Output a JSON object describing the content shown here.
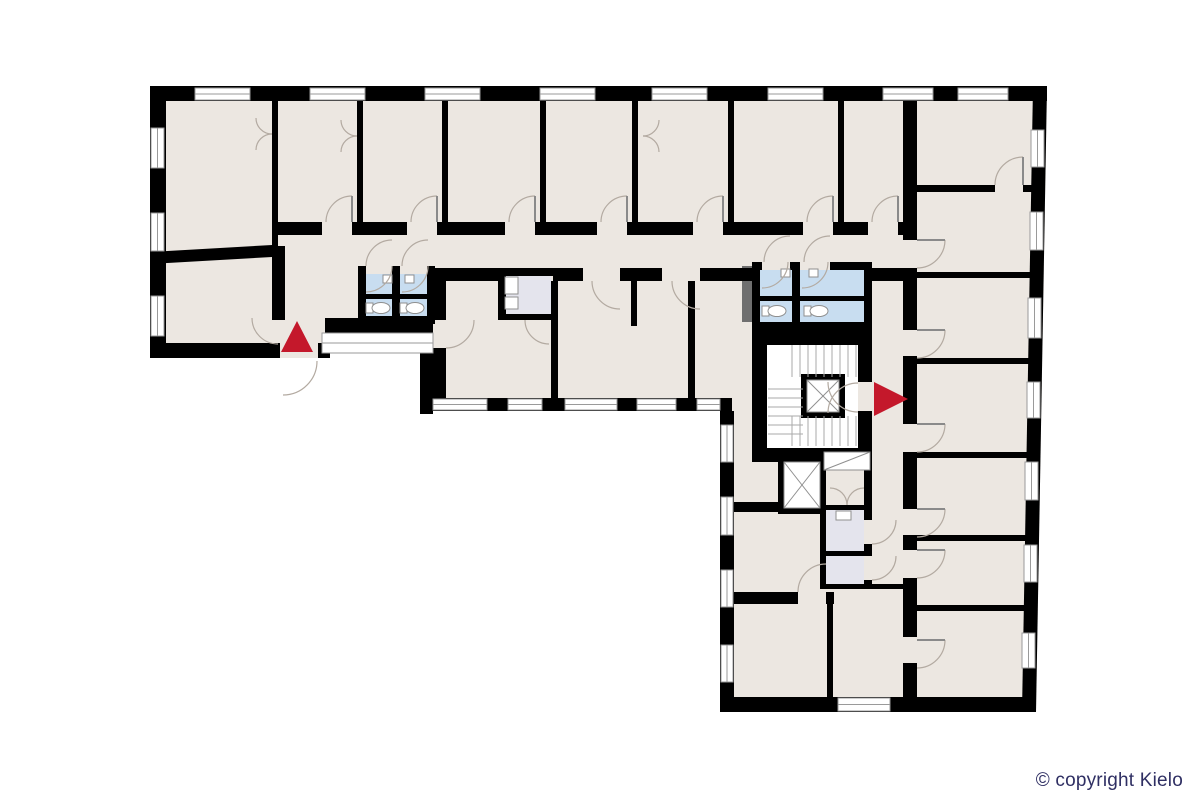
{
  "copyright": {
    "text": "© copyright Kielo",
    "color": "#2f2f63"
  },
  "canvas": {
    "width": 1200,
    "height": 800,
    "background": "#ffffff"
  },
  "colors": {
    "floor": "#ece7e1",
    "wall": "#000000",
    "wet": "#c8ddf0",
    "utility": "#e4e4ed",
    "shaft": "#6f6f6f",
    "accent": "#c4182b",
    "window_stroke": "#9a9a9a",
    "fixture_stroke": "#8f8f8f",
    "door_stroke": "#b3aaa1",
    "stair_stroke": "#aaaaaa",
    "leaf_stroke": "#8a8a8a"
  },
  "floorplan": {
    "floor": {
      "points": "150,86 1047,86 1036,712 720,712 720,411 433,411 433,318 325,318 325,358 150,358"
    },
    "white_rects": [
      [
        767,
        345,
        91,
        103
      ]
    ],
    "utility_rects": [
      [
        506,
        274,
        45,
        40
      ],
      [
        826,
        510,
        38,
        41
      ],
      [
        826,
        556,
        38,
        28
      ]
    ],
    "wet_rects": [
      [
        366,
        274,
        26,
        20
      ],
      [
        400,
        274,
        27,
        20
      ],
      [
        366,
        299,
        26,
        17
      ],
      [
        400,
        299,
        27,
        17
      ],
      [
        760,
        270,
        32,
        26
      ],
      [
        800,
        270,
        64,
        26
      ],
      [
        760,
        301,
        32,
        21
      ],
      [
        800,
        301,
        64,
        21
      ]
    ],
    "shaft_rects": [
      [
        742,
        266,
        10,
        56
      ]
    ],
    "wall_rects": [
      [
        150,
        86,
        897,
        15
      ],
      [
        150,
        86,
        16,
        272
      ],
      [
        150,
        343,
        130,
        15
      ],
      [
        318,
        343,
        12,
        15
      ],
      [
        325,
        318,
        108,
        15
      ],
      [
        420,
        318,
        13,
        96
      ],
      [
        420,
        398,
        312,
        13
      ],
      [
        720,
        411,
        14,
        301
      ],
      [
        720,
        697,
        316,
        15
      ],
      [
        277,
        222,
        45,
        13
      ],
      [
        352,
        222,
        55,
        13
      ],
      [
        437,
        222,
        68,
        13
      ],
      [
        535,
        222,
        62,
        13
      ],
      [
        627,
        222,
        66,
        13
      ],
      [
        723,
        222,
        80,
        13
      ],
      [
        833,
        222,
        35,
        13
      ],
      [
        898,
        222,
        8,
        13
      ],
      [
        446,
        268,
        52,
        13
      ],
      [
        498,
        268,
        55,
        8
      ],
      [
        553,
        268,
        30,
        13
      ],
      [
        620,
        268,
        42,
        13
      ],
      [
        700,
        268,
        52,
        13
      ],
      [
        872,
        268,
        31,
        13
      ],
      [
        357,
        101,
        6,
        121
      ],
      [
        442,
        101,
        6,
        121
      ],
      [
        540,
        101,
        6,
        121
      ],
      [
        632,
        101,
        6,
        121
      ],
      [
        728,
        101,
        6,
        121
      ],
      [
        838,
        101,
        6,
        121
      ],
      [
        272,
        101,
        6,
        147
      ],
      [
        272,
        246,
        13,
        74
      ],
      [
        551,
        281,
        7,
        117
      ],
      [
        688,
        281,
        7,
        117
      ],
      [
        631,
        281,
        6,
        45
      ],
      [
        433,
        268,
        13,
        52
      ],
      [
        433,
        348,
        13,
        50
      ],
      [
        903,
        101,
        14,
        139
      ],
      [
        903,
        268,
        14,
        62
      ],
      [
        903,
        356,
        14,
        68
      ],
      [
        903,
        452,
        14,
        57
      ],
      [
        903,
        535,
        14,
        15
      ],
      [
        903,
        578,
        14,
        59
      ],
      [
        903,
        663,
        14,
        34
      ],
      [
        917,
        185,
        78,
        7
      ],
      [
        1023,
        185,
        10,
        7
      ],
      [
        917,
        272,
        113,
        6
      ],
      [
        917,
        358,
        112,
        6
      ],
      [
        917,
        452,
        110,
        6
      ],
      [
        917,
        535,
        109,
        6
      ],
      [
        917,
        605,
        107,
        6
      ],
      [
        358,
        266,
        6,
        8
      ],
      [
        392,
        266,
        8,
        8
      ],
      [
        428,
        266,
        7,
        8
      ],
      [
        358,
        266,
        8,
        56
      ],
      [
        427,
        266,
        8,
        56
      ],
      [
        392,
        266,
        8,
        56
      ],
      [
        358,
        316,
        77,
        8
      ],
      [
        358,
        294,
        77,
        5
      ],
      [
        752,
        262,
        10,
        8
      ],
      [
        790,
        262,
        10,
        8
      ],
      [
        830,
        262,
        42,
        8
      ],
      [
        752,
        262,
        8,
        68
      ],
      [
        864,
        262,
        8,
        68
      ],
      [
        792,
        262,
        8,
        68
      ],
      [
        752,
        322,
        120,
        8
      ],
      [
        752,
        296,
        120,
        5
      ],
      [
        498,
        268,
        8,
        52
      ],
      [
        498,
        314,
        53,
        6
      ],
      [
        752,
        330,
        120,
        15
      ],
      [
        752,
        330,
        15,
        130
      ],
      [
        752,
        448,
        120,
        14
      ],
      [
        858,
        330,
        14,
        52
      ],
      [
        858,
        411,
        14,
        37
      ],
      [
        822,
        450,
        50,
        5
      ],
      [
        820,
        505,
        52,
        5
      ],
      [
        820,
        505,
        6,
        81
      ],
      [
        864,
        455,
        8,
        65
      ],
      [
        864,
        544,
        8,
        12
      ],
      [
        864,
        580,
        8,
        6
      ],
      [
        820,
        551,
        52,
        5
      ],
      [
        820,
        584,
        97,
        5
      ],
      [
        734,
        502,
        46,
        10
      ],
      [
        734,
        592,
        64,
        12
      ],
      [
        826,
        592,
        8,
        12
      ],
      [
        827,
        604,
        6,
        93
      ]
    ],
    "wall_polys": [
      "1033,86 1047,86 1036,712 1022,712",
      "150,252 272,245 272,257 150,264"
    ],
    "windows": [
      [
        195,
        88,
        55,
        12
      ],
      [
        310,
        88,
        55,
        12
      ],
      [
        425,
        88,
        55,
        12
      ],
      [
        540,
        88,
        55,
        12
      ],
      [
        652,
        88,
        55,
        12
      ],
      [
        768,
        88,
        55,
        12
      ],
      [
        883,
        88,
        50,
        12
      ],
      [
        958,
        88,
        50,
        12
      ],
      [
        151,
        128,
        13,
        40
      ],
      [
        151,
        213,
        13,
        38
      ],
      [
        151,
        296,
        13,
        40
      ],
      [
        1031,
        130,
        13,
        37
      ],
      [
        1030,
        212,
        13,
        38
      ],
      [
        1028,
        298,
        13,
        40
      ],
      [
        1027,
        382,
        13,
        36
      ],
      [
        1025,
        462,
        13,
        38
      ],
      [
        1024,
        545,
        13,
        37
      ],
      [
        1022,
        633,
        13,
        35
      ],
      [
        838,
        698,
        52,
        13
      ],
      [
        721,
        425,
        12,
        37
      ],
      [
        721,
        497,
        12,
        38
      ],
      [
        721,
        570,
        12,
        37
      ],
      [
        721,
        645,
        12,
        37
      ],
      [
        433,
        399,
        54,
        11
      ],
      [
        508,
        399,
        34,
        11
      ],
      [
        565,
        399,
        52,
        11
      ],
      [
        637,
        399,
        39,
        11
      ],
      [
        697,
        399,
        23,
        11
      ],
      [
        322,
        333,
        111,
        20
      ]
    ],
    "elevators": [
      {
        "f": [
          801,
          374,
          44,
          44
        ],
        "c": [
          807,
          380,
          32,
          32
        ]
      },
      {
        "f": [
          778,
          456,
          48,
          58
        ],
        "c": [
          784,
          462,
          36,
          46
        ]
      }
    ],
    "duct": {
      "r": [
        824,
        452,
        46,
        18
      ]
    },
    "stairs": [
      {
        "o": "v",
        "s": 792,
        "e": 856,
        "step": 8,
        "a": 345,
        "b": 377
      },
      {
        "o": "v",
        "s": 792,
        "e": 856,
        "step": 8,
        "a": 416,
        "b": 446
      },
      {
        "o": "h",
        "s": 389,
        "e": 434,
        "step": 9,
        "a": 768,
        "b": 803
      }
    ],
    "toilets": [
      {
        "x": 380,
        "y": 308
      },
      {
        "x": 414,
        "y": 308
      },
      {
        "x": 776,
        "y": 311
      },
      {
        "x": 818,
        "y": 311
      }
    ],
    "sinks": [
      [
        383,
        275,
        9,
        8
      ],
      [
        405,
        275,
        9,
        8
      ],
      [
        781,
        269,
        9,
        8
      ],
      [
        809,
        269,
        9,
        8
      ],
      [
        836,
        511,
        15,
        9
      ],
      [
        505,
        277,
        13,
        17
      ],
      [
        505,
        297,
        13,
        12
      ]
    ],
    "doors": [
      {
        "a": [
          326,
          222,
          26,
          352,
          196,
          1
        ],
        "h": [
          352,
          222
        ]
      },
      {
        "a": [
          411,
          222,
          26,
          437,
          196,
          1
        ],
        "h": [
          437,
          222
        ]
      },
      {
        "a": [
          509,
          222,
          26,
          535,
          196,
          1
        ],
        "h": [
          535,
          222
        ]
      },
      {
        "a": [
          601,
          222,
          26,
          627,
          196,
          1
        ],
        "h": [
          627,
          222
        ]
      },
      {
        "a": [
          697,
          222,
          26,
          723,
          196,
          1
        ],
        "h": [
          723,
          222
        ]
      },
      {
        "a": [
          807,
          222,
          26,
          833,
          196,
          1
        ],
        "h": [
          833,
          222
        ]
      },
      {
        "a": [
          872,
          222,
          26,
          898,
          196,
          1
        ],
        "h": [
          898,
          222
        ]
      },
      {
        "a": [
          592,
          281,
          28,
          620,
          309,
          0
        ]
      },
      {
        "a": [
          672,
          281,
          28,
          700,
          309,
          0
        ]
      },
      {
        "a": [
          917,
          268,
          28,
          945,
          240,
          0
        ],
        "h": [
          917,
          240
        ]
      },
      {
        "a": [
          917,
          358,
          28,
          945,
          330,
          0
        ],
        "h": [
          917,
          330
        ]
      },
      {
        "a": [
          917,
          452,
          28,
          945,
          424,
          0
        ],
        "h": [
          917,
          424
        ]
      },
      {
        "a": [
          917,
          537,
          28,
          945,
          509,
          0
        ],
        "h": [
          917,
          509
        ]
      },
      {
        "a": [
          917,
          578,
          28,
          945,
          550,
          0
        ],
        "h": [
          917,
          550
        ]
      },
      {
        "a": [
          917,
          668,
          28,
          945,
          640,
          0
        ],
        "h": [
          917,
          640
        ]
      },
      {
        "a": [
          995,
          185,
          28,
          1023,
          157,
          1
        ],
        "h": [
          1023,
          185
        ]
      },
      {
        "a": [
          858,
          412,
          30,
          828,
          382,
          1
        ]
      },
      {
        "a": [
          858,
          383,
          30,
          828,
          413,
          0
        ]
      },
      {
        "a": [
          847,
          505,
          17,
          830,
          488,
          0
        ]
      },
      {
        "a": [
          847,
          505,
          17,
          864,
          488,
          1
        ]
      },
      {
        "a": [
          872,
          544,
          24,
          896,
          520,
          0
        ]
      },
      {
        "a": [
          872,
          580,
          24,
          896,
          556,
          0
        ]
      },
      {
        "a": [
          798,
          592,
          28,
          826,
          564,
          1
        ]
      },
      {
        "a": [
          252,
          318,
          26,
          278,
          344,
          0
        ]
      },
      {
        "a": [
          283,
          395,
          34,
          317,
          361,
          0
        ]
      },
      {
        "a": [
          446,
          348,
          28,
          474,
          320,
          0
        ]
      },
      {
        "a": [
          256,
          118,
          16,
          272,
          134,
          0
        ]
      },
      {
        "a": [
          256,
          150,
          16,
          272,
          134,
          1
        ]
      },
      {
        "a": [
          341,
          120,
          16,
          357,
          136,
          0
        ]
      },
      {
        "a": [
          341,
          152,
          16,
          357,
          136,
          1
        ]
      },
      {
        "a": [
          659,
          120,
          16,
          643,
          136,
          1
        ]
      },
      {
        "a": [
          659,
          152,
          16,
          643,
          136,
          0
        ]
      },
      {
        "a": [
          366,
          266,
          26,
          392,
          240,
          1
        ]
      },
      {
        "a": [
          402,
          266,
          26,
          428,
          240,
          1
        ]
      },
      {
        "a": [
          392,
          266,
          26,
          366,
          292,
          1
        ]
      },
      {
        "a": [
          428,
          266,
          26,
          402,
          292,
          1
        ]
      },
      {
        "a": [
          764,
          262,
          26,
          790,
          236,
          1
        ]
      },
      {
        "a": [
          804,
          262,
          26,
          830,
          236,
          1
        ]
      },
      {
        "a": [
          788,
          262,
          26,
          762,
          288,
          1
        ]
      },
      {
        "a": [
          828,
          262,
          26,
          802,
          288,
          1
        ]
      },
      {
        "a": [
          525,
          320,
          24,
          549,
          344,
          0
        ]
      }
    ],
    "arrows": [
      {
        "name": "entrance-arrow-up",
        "points": "281,352 313,352 297,321"
      },
      {
        "name": "stair-exit-arrow-right",
        "points": "874,382 874,416 908,399"
      }
    ]
  }
}
